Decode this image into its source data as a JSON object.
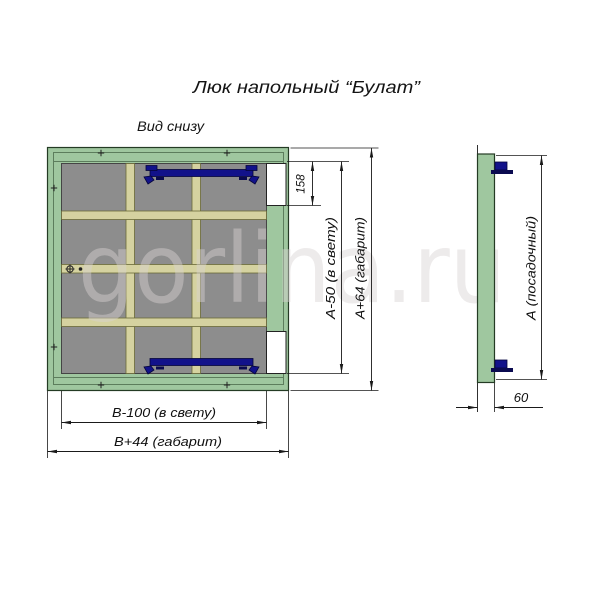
{
  "title": "Люк напольный “Булат”",
  "view_label": "Вид снизу",
  "watermark": "gorlina.ru",
  "dimensions": {
    "latch_offset": "158",
    "height_clear": "А-50 (в свету)",
    "height_overall": "А+64 (габарит)",
    "width_clear": "В-100 (в свету)",
    "width_overall": "В+44 (габарит)",
    "seat_height": "А (посадочный)",
    "profile_depth": "60"
  },
  "colors": {
    "frame_green": "#9fc79f",
    "frame_edge": "#243b24",
    "frame_detail": "#5c7d5c",
    "panel_gray": "#8d8d8d",
    "rib_beige": "#d5d2a0",
    "hinge_navy": "#12128a",
    "dimension_line": "#1a1a1a",
    "watermark_gray": "#d9d3d3"
  }
}
